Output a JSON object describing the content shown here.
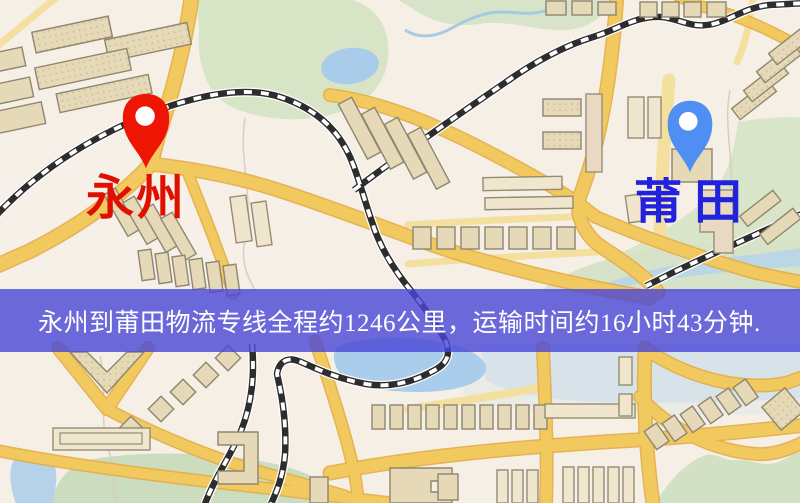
{
  "map": {
    "description": "stylized city street map with two logistics route endpoints",
    "origin": {
      "name": "永州",
      "pin_color": "#ee1505",
      "label_color": "#e01000"
    },
    "destination": {
      "name": "莆田",
      "pin_color": "#4f8ef2",
      "label_color": "#2222dd"
    }
  },
  "banner": {
    "text": "永州到莆田物流专线全程约1246公里，运输时间约16小时43分钟.",
    "route": "永州到莆田物流专线",
    "distance_km": "1246",
    "duration": "16小时43分钟",
    "background": "rgba(72,70,215,0.8)",
    "text_color": "#ffffff"
  }
}
